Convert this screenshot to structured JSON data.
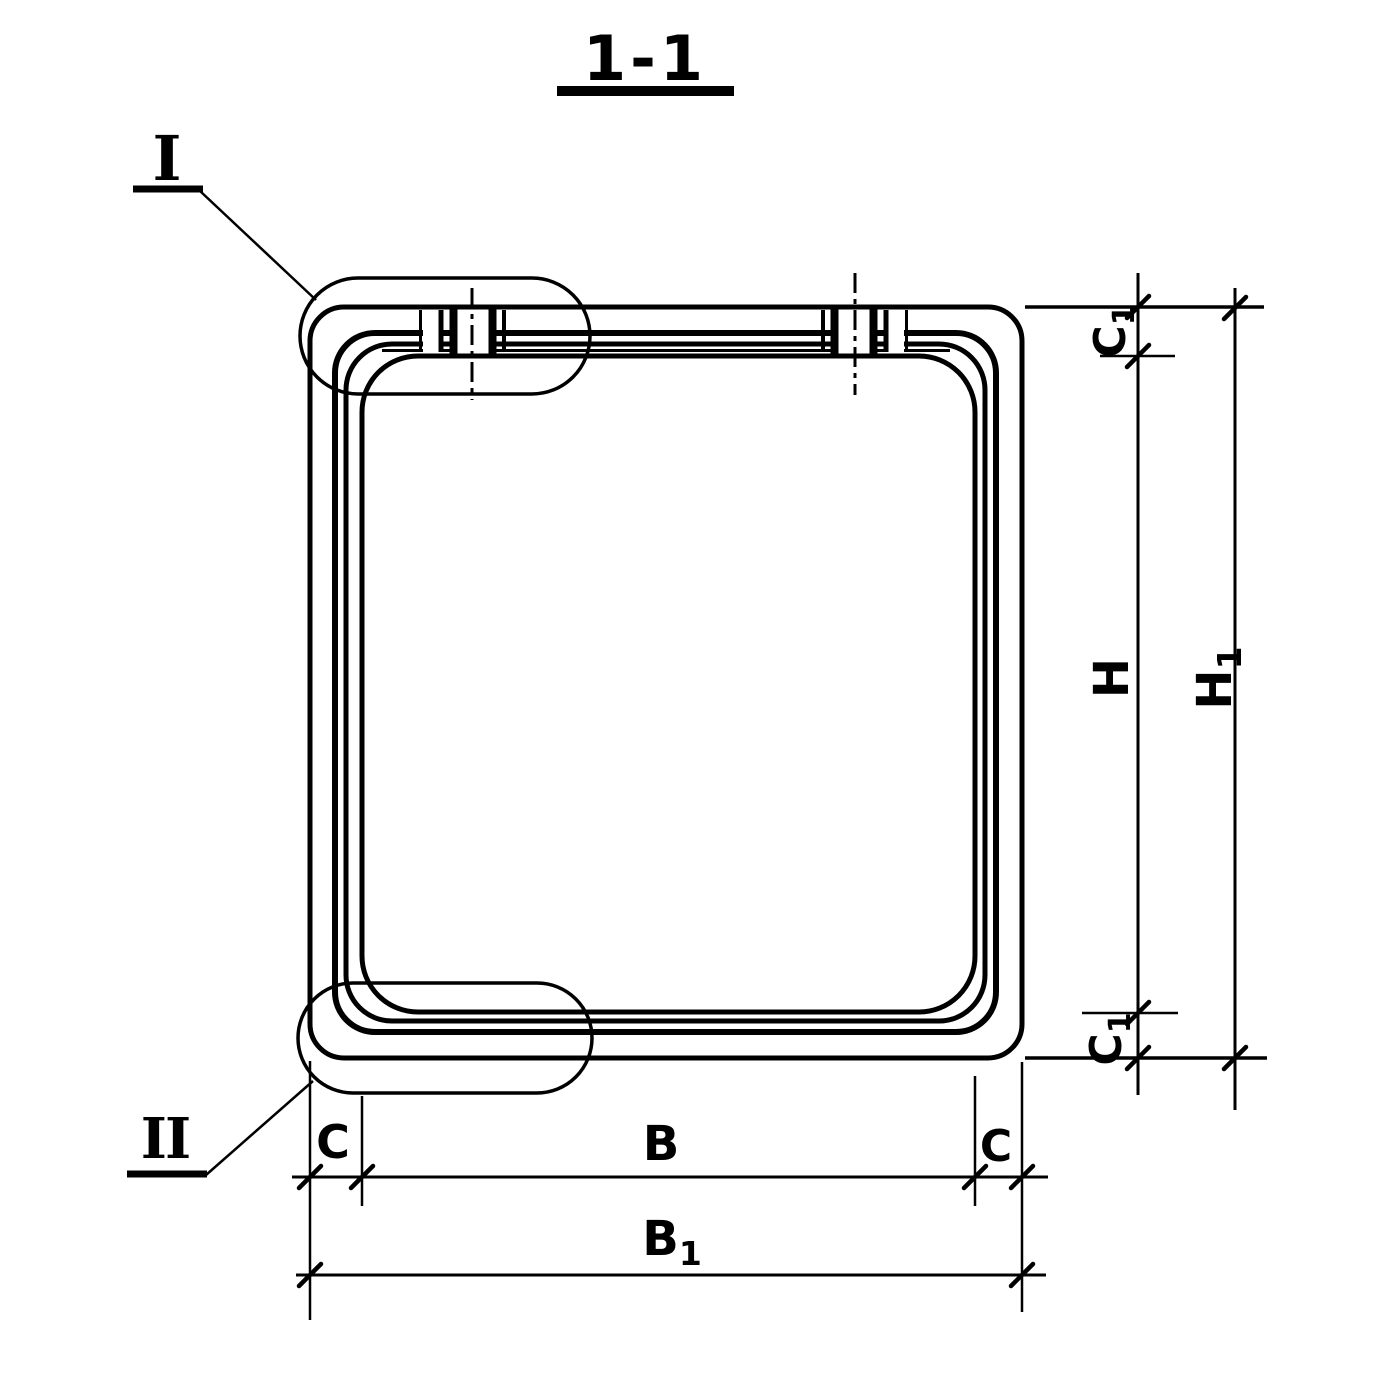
{
  "title": {
    "section_label": "1-1"
  },
  "callouts": {
    "detail_top": "I",
    "detail_bottom": "II"
  },
  "dimensions": {
    "c1_top": {
      "base": "C",
      "sub": "1"
    },
    "h_inner": {
      "base": "H",
      "sub": ""
    },
    "h1_overall": {
      "base": "H",
      "sub": "1"
    },
    "c1_bottom": {
      "base": "C",
      "sub": "1"
    },
    "c_left": {
      "base": "C",
      "sub": ""
    },
    "b_inner": {
      "base": "B",
      "sub": ""
    },
    "c_right": {
      "base": "C",
      "sub": ""
    },
    "b1_overall": {
      "base": "B",
      "sub": "1"
    }
  },
  "colors": {
    "ink": "#000000",
    "paper": "#ffffff"
  }
}
